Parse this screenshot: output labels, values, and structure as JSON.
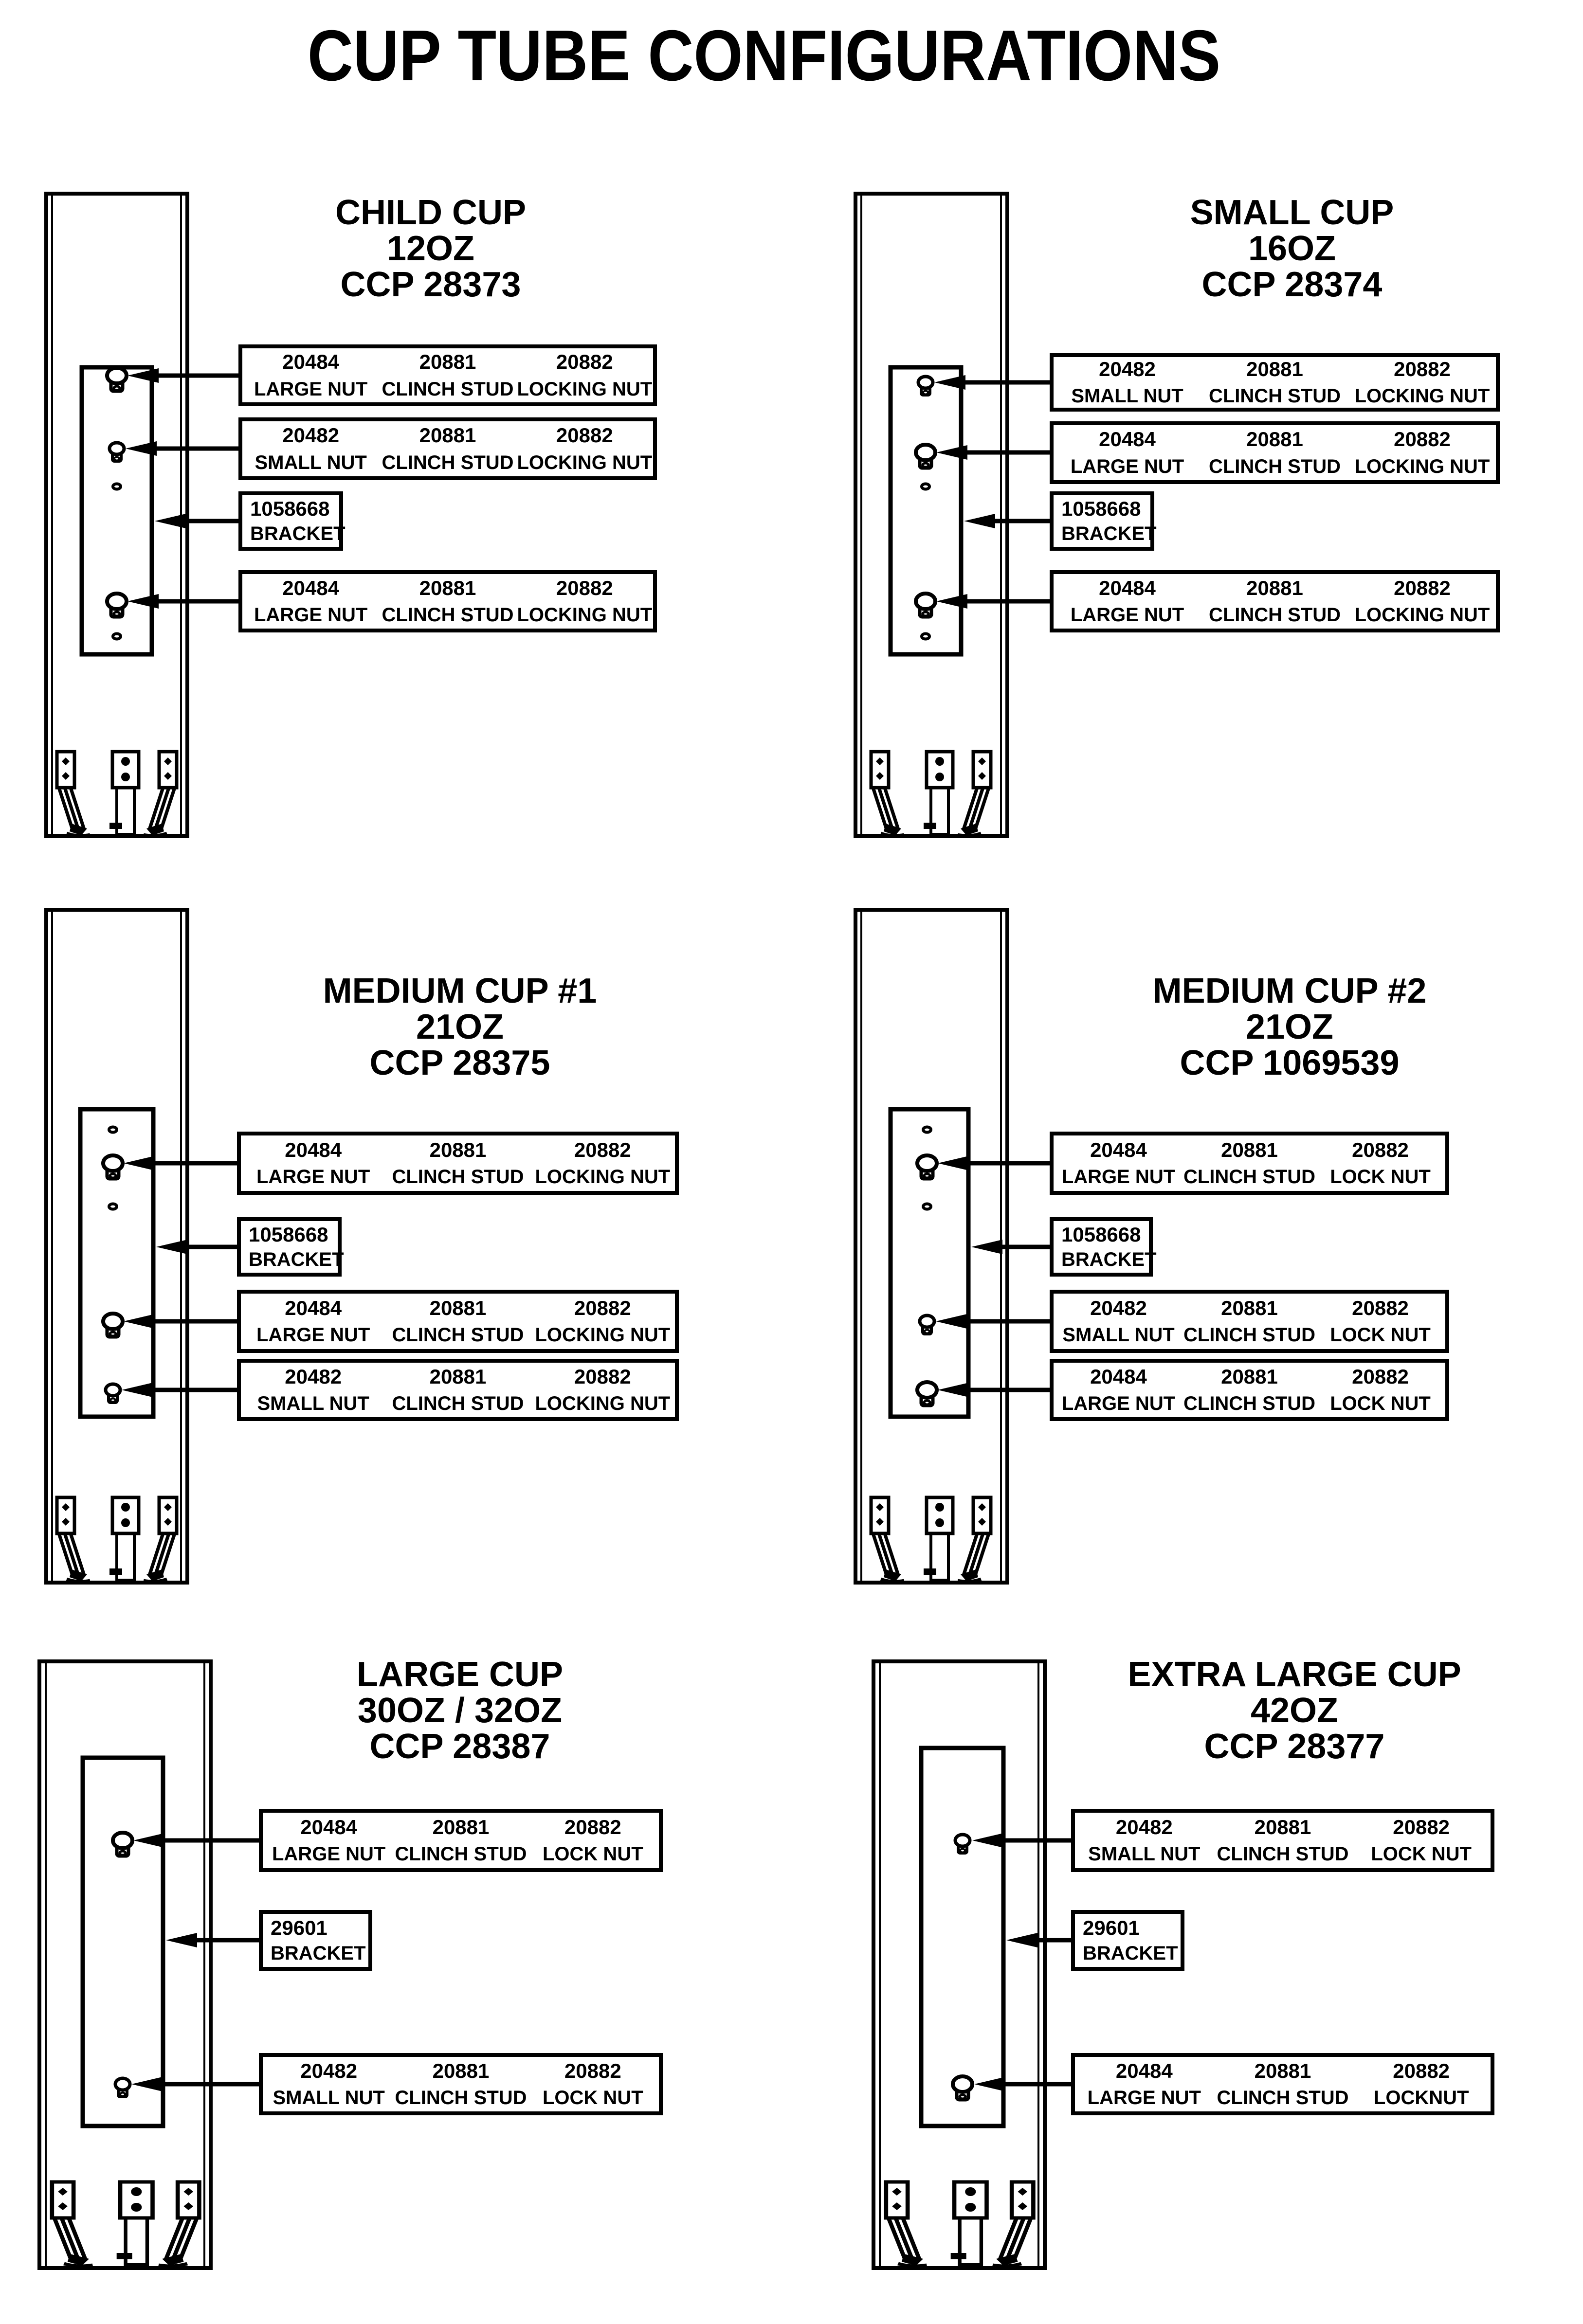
{
  "page": {
    "title": "CUP TUBE CONFIGURATIONS",
    "ink_color": "#000000",
    "paper_color": "#ffffff"
  },
  "icons": {
    "large_stud": "keyhole-stud-icon",
    "small_stud": "keyhole-stud-small-icon",
    "hole": "hole-dot-icon",
    "arrow": "leader-arrow-left-icon"
  },
  "panels": [
    {
      "name": "CHILD CUP",
      "size": "12OZ",
      "ccp": "CCP 28373",
      "boxes": [
        {
          "cols": [
            {
              "num": "20484",
              "label": "LARGE NUT"
            },
            {
              "num": "20881",
              "label": "CLINCH STUD"
            },
            {
              "num": "20882",
              "label": "LOCKING NUT"
            }
          ]
        },
        {
          "cols": [
            {
              "num": "20482",
              "label": "SMALL NUT"
            },
            {
              "num": "20881",
              "label": "CLINCH STUD"
            },
            {
              "num": "20882",
              "label": "LOCKING NUT"
            }
          ]
        },
        {
          "num": "1058668",
          "label": "BRACKET"
        },
        {
          "cols": [
            {
              "num": "20484",
              "label": "LARGE NUT"
            },
            {
              "num": "20881",
              "label": "CLINCH STUD"
            },
            {
              "num": "20882",
              "label": "LOCKING NUT"
            }
          ]
        }
      ]
    },
    {
      "name": "SMALL CUP",
      "size": "16OZ",
      "ccp": "CCP 28374",
      "boxes": [
        {
          "cols": [
            {
              "num": "20482",
              "label": "SMALL NUT"
            },
            {
              "num": "20881",
              "label": "CLINCH STUD"
            },
            {
              "num": "20882",
              "label": "LOCKING NUT"
            }
          ]
        },
        {
          "cols": [
            {
              "num": "20484",
              "label": "LARGE NUT"
            },
            {
              "num": "20881",
              "label": "CLINCH STUD"
            },
            {
              "num": "20882",
              "label": "LOCKING NUT"
            }
          ]
        },
        {
          "num": "1058668",
          "label": "BRACKET"
        },
        {
          "cols": [
            {
              "num": "20484",
              "label": "LARGE NUT"
            },
            {
              "num": "20881",
              "label": "CLINCH STUD"
            },
            {
              "num": "20882",
              "label": "LOCKING NUT"
            }
          ]
        }
      ]
    },
    {
      "name": "MEDIUM CUP #1",
      "size": "21OZ",
      "ccp": "CCP 28375",
      "boxes": [
        {
          "cols": [
            {
              "num": "20484",
              "label": "LARGE NUT"
            },
            {
              "num": "20881",
              "label": "CLINCH STUD"
            },
            {
              "num": "20882",
              "label": "LOCKING NUT"
            }
          ]
        },
        {
          "num": "1058668",
          "label": "BRACKET"
        },
        {
          "cols": [
            {
              "num": "20484",
              "label": "LARGE NUT"
            },
            {
              "num": "20881",
              "label": "CLINCH STUD"
            },
            {
              "num": "20882",
              "label": "LOCKING NUT"
            }
          ]
        },
        {
          "cols": [
            {
              "num": "20482",
              "label": "SMALL NUT"
            },
            {
              "num": "20881",
              "label": "CLINCH STUD"
            },
            {
              "num": "20882",
              "label": "LOCKING NUT"
            }
          ]
        }
      ]
    },
    {
      "name": "MEDIUM CUP #2",
      "size": "21OZ",
      "ccp": "CCP 1069539",
      "boxes": [
        {
          "cols": [
            {
              "num": "20484",
              "label": "LARGE NUT"
            },
            {
              "num": "20881",
              "label": "CLINCH STUD"
            },
            {
              "num": "20882",
              "label": "LOCK NUT"
            }
          ]
        },
        {
          "num": "1058668",
          "label": "BRACKET"
        },
        {
          "cols": [
            {
              "num": "20482",
              "label": "SMALL NUT"
            },
            {
              "num": "20881",
              "label": "CLINCH STUD"
            },
            {
              "num": "20882",
              "label": "LOCK NUT"
            }
          ]
        },
        {
          "cols": [
            {
              "num": "20484",
              "label": "LARGE NUT"
            },
            {
              "num": "20881",
              "label": "CLINCH STUD"
            },
            {
              "num": "20882",
              "label": "LOCK NUT"
            }
          ]
        }
      ]
    },
    {
      "name": "LARGE CUP",
      "size": "30OZ / 32OZ",
      "ccp": "CCP 28387",
      "boxes": [
        {
          "cols": [
            {
              "num": "20484",
              "label": "LARGE NUT"
            },
            {
              "num": "20881",
              "label": "CLINCH STUD"
            },
            {
              "num": "20882",
              "label": "LOCK NUT"
            }
          ]
        },
        {
          "num": "29601",
          "label": "BRACKET"
        },
        {
          "cols": [
            {
              "num": "20482",
              "label": "SMALL NUT"
            },
            {
              "num": "20881",
              "label": "CLINCH STUD"
            },
            {
              "num": "20882",
              "label": "LOCK NUT"
            }
          ]
        }
      ]
    },
    {
      "name": "EXTRA LARGE CUP",
      "size": "42OZ",
      "ccp": "CCP 28377",
      "boxes": [
        {
          "cols": [
            {
              "num": "20482",
              "label": "SMALL NUT"
            },
            {
              "num": "20881",
              "label": "CLINCH STUD"
            },
            {
              "num": "20882",
              "label": "LOCK NUT"
            }
          ]
        },
        {
          "num": "29601",
          "label": "BRACKET"
        },
        {
          "cols": [
            {
              "num": "20484",
              "label": "LARGE NUT"
            },
            {
              "num": "20881",
              "label": "CLINCH STUD"
            },
            {
              "num": "20882",
              "label": "LOCKNUT"
            }
          ]
        }
      ]
    }
  ]
}
